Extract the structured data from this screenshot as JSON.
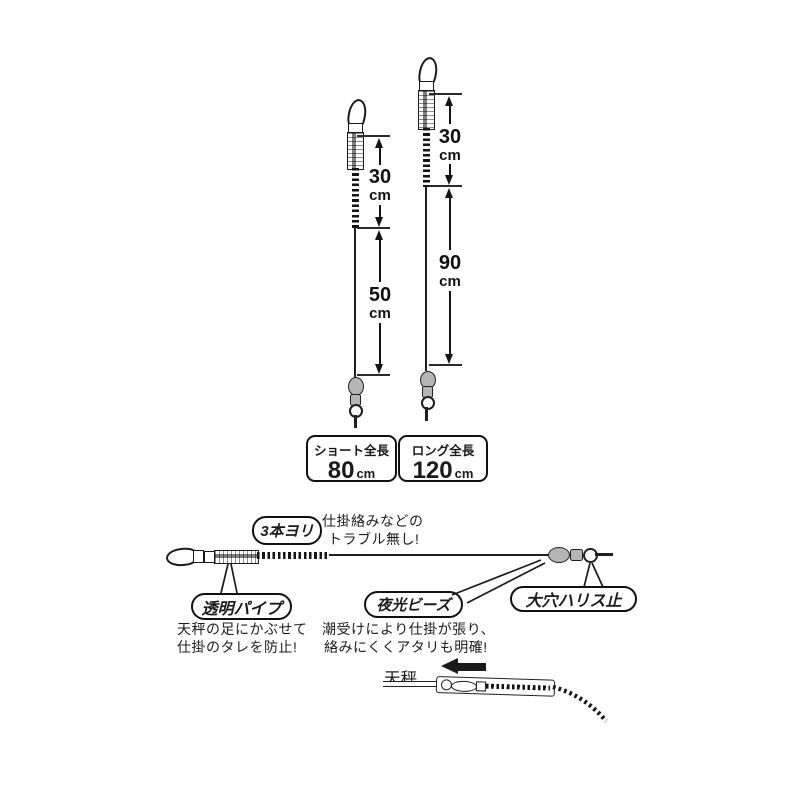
{
  "colors": {
    "ink": "#1a1a1a",
    "metal_gray": "#b5b5b5",
    "background": "#ffffff"
  },
  "rigs": {
    "short": {
      "segments": [
        {
          "value": "30",
          "unit": "cm"
        },
        {
          "value": "50",
          "unit": "cm"
        }
      ],
      "total": {
        "label": "ショート全長",
        "value": "80",
        "unit": "cm"
      }
    },
    "long": {
      "segments": [
        {
          "value": "30",
          "unit": "cm"
        },
        {
          "value": "90",
          "unit": "cm"
        }
      ],
      "total": {
        "label": "ロング全長",
        "value": "120",
        "unit": "cm"
      }
    }
  },
  "callouts": {
    "twist": {
      "label": "3本ヨリ",
      "note": [
        "仕掛絡みなどの",
        "トラブル無し!"
      ]
    },
    "pipe": {
      "label": "透明パイプ",
      "note": [
        "天秤の足にかぶせて",
        "仕掛のタレを防止!"
      ]
    },
    "beads": {
      "label": "夜光ビーズ",
      "note": [
        "潮受けにより仕掛が張り、",
        "絡みにくくアタリも明確!"
      ]
    },
    "stopper": {
      "label": "大穴ハリス止"
    },
    "tenbin": {
      "label": "天秤"
    }
  }
}
